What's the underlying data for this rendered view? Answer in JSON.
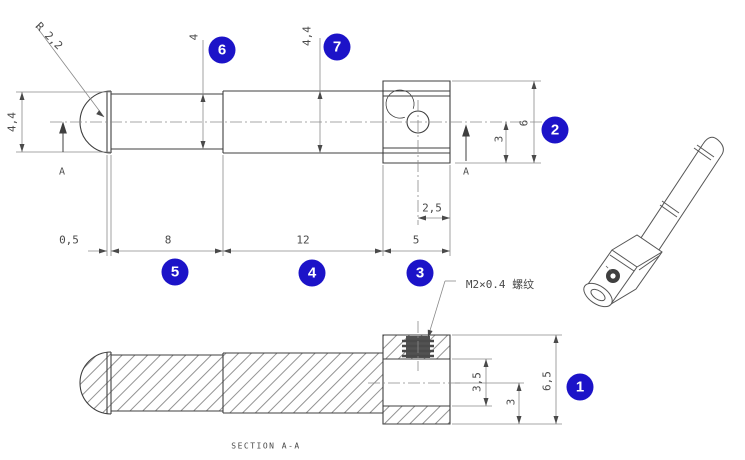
{
  "colors": {
    "badge": "#1c13c8",
    "outline": "#3f3f3f",
    "dim_line": "#8a8a8a",
    "text": "#4a4a4a",
    "background": "#ffffff"
  },
  "badges": [
    "1",
    "2",
    "3",
    "4",
    "5",
    "6",
    "7"
  ],
  "front_view": {
    "dims": {
      "tip_radius": "R 2,2",
      "tip_diameter": "4,4",
      "neck_width": "0,5",
      "mid_diameter": "4",
      "body_diameter": "4,4",
      "segment1_length": "8",
      "segment2_length": "12",
      "head_length": "5",
      "head_height": "6",
      "axis_to_bottom": "3",
      "hole_to_end": "2,5"
    },
    "section_marks": {
      "left": "A",
      "right": "A"
    }
  },
  "section_view": {
    "label": "SECTION A-A",
    "thread_callout": "M2×0.4 螺纹",
    "dims": {
      "hole_depth": "3,5",
      "axis_to_bottom": "3",
      "head_total_height": "6,5"
    }
  }
}
